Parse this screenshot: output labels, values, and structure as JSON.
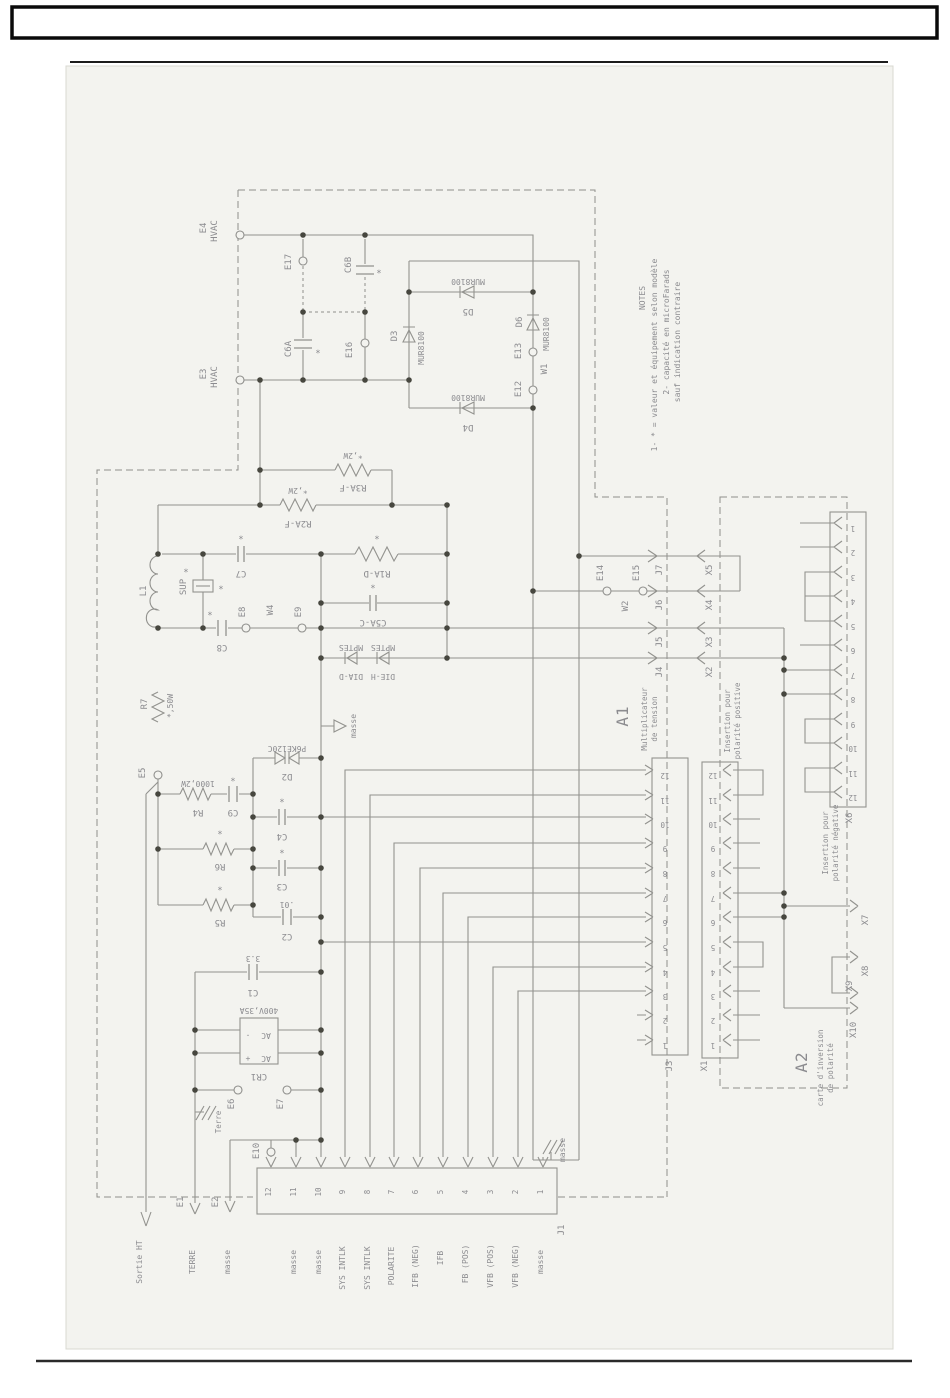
{
  "page": {
    "scan_bg": "#f3f3ef",
    "ink": "#8f8f8c"
  },
  "notes": {
    "title": "NOTES",
    "n1": "1- * = valeur et équipement selon modèle",
    "n2": "2- capacité en microFarads",
    "n3": "sauf indication contraire"
  },
  "labels": {
    "e4": "E4",
    "e4_sub": "HVAC",
    "e3": "E3",
    "e3_sub": "HVAC",
    "e17": "E17",
    "e16": "E16",
    "c6a": "C6A",
    "c6b": "C6B",
    "star": "*",
    "d3": "D3",
    "d3_part": "MUR8100",
    "d5": "D5",
    "d5_part": "MUR8100",
    "d4": "D4",
    "d4_part": "MUR8100",
    "d6": "D6",
    "d6_part": "MUR8100",
    "e13": "E13",
    "e12": "E12",
    "w1": "W1",
    "r3af": "R3A-F",
    "r3af_val": "*,2W",
    "r2af": "R2A-F",
    "r2af_val": "*,2W",
    "l1": "L1",
    "sup": "SUP",
    "c7": "C7",
    "r1ad": "R1A-D",
    "c5ac": "C5A-C",
    "c8": "C8",
    "e8": "E8",
    "w4": "W4",
    "e9": "E9",
    "mptes": "MPTES",
    "dia_d": "DIA-D",
    "die_h": "DIE-H",
    "masse": "masse",
    "r7": "R7",
    "r7_val": "*,50W",
    "e5": "E5",
    "r4": "R4",
    "r4_val": "1000,2W",
    "c9": "C9",
    "d2": "D2",
    "d2_part": "P6KE120C",
    "c4": "C4",
    "r6": "R6",
    "c3": "C3",
    "r5": "R5",
    "c2": "C2",
    "c2_val": ".01",
    "c1": "C1",
    "c1_val": "3.3",
    "cr1": "CR1",
    "cr1_val": "400V,35A",
    "ac": "AC",
    "plus": "+",
    "minus": "-",
    "e6": "E6",
    "terre": "Terre",
    "e7": "E7",
    "e10": "E10",
    "e14": "E14",
    "e15": "E15",
    "w2": "W2",
    "a1": "A1",
    "a1_sub1": "Multiplicateur",
    "a1_sub2": "de tension",
    "a2": "A2",
    "a2_sub1": "carte d'inversion",
    "a2_sub2": "de polarité",
    "ins_pos1": "Insertion pour",
    "ins_pos2": "polarité positive",
    "ins_neg1": "Insertion pour",
    "ins_neg2": "polarité négative",
    "j7": "J7",
    "j6": "J6",
    "j5": "J5",
    "j4": "J4",
    "x5": "X5",
    "x4": "X4",
    "x3": "X3",
    "x2": "X2",
    "x7": "X7",
    "x8": "X8",
    "x9": "X9",
    "x10": "X10",
    "e1": "E1",
    "e2": "E2"
  },
  "left_terminals": {
    "sortie": "Sortie HT",
    "e1_sig": "TERRE",
    "e2_sig": "masse"
  },
  "connectors": {
    "j1": {
      "name": "J1",
      "pins": [
        "12",
        "11",
        "10",
        "9",
        "8",
        "7",
        "6",
        "5",
        "4",
        "3",
        "2",
        "1"
      ],
      "signals": [
        "",
        "masse",
        "masse",
        "SYS INTLK",
        "SYS INTLK",
        "POLARITE",
        "IFB (NEG)",
        "IFB",
        "FB (POS)",
        "VFB (POS)",
        "VFB (NEG)",
        "masse"
      ],
      "gnd_label": "masse"
    },
    "j3": {
      "name": "J3",
      "pins": [
        "12",
        "11",
        "10",
        "9",
        "8",
        "7",
        "6",
        "5",
        "4",
        "3",
        "2",
        "1"
      ]
    },
    "x1": {
      "name": "X1",
      "pins": [
        "12",
        "11",
        "10",
        "9",
        "8",
        "7",
        "6",
        "5",
        "4",
        "3",
        "2",
        "1"
      ]
    },
    "x6": {
      "name": "X6",
      "pins": [
        "1",
        "2",
        "3",
        "4",
        "5",
        "6",
        "7",
        "8",
        "9",
        "10",
        "11",
        "12"
      ]
    }
  }
}
